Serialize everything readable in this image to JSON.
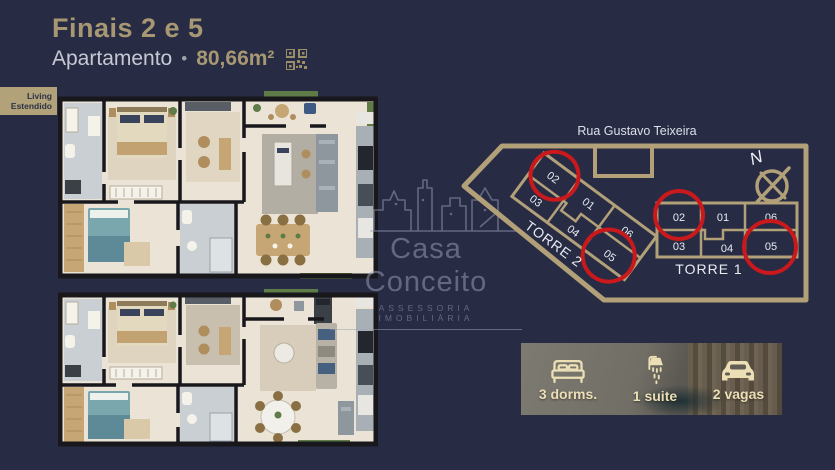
{
  "header": {
    "title": "Finais 2 e 5",
    "subtitle": "Apartamento",
    "separator": "•",
    "area": "80,66m²"
  },
  "badge": {
    "label": "Living Estendido"
  },
  "watermark": {
    "brand": "Casa Conceito",
    "tagline": "ASSESSORIA IMOBILIÁRIA"
  },
  "site_plan": {
    "street": "Rua Gustavo Teixeira",
    "north": "N",
    "tower_1": {
      "name": "TORRE 1",
      "units": {
        "u02": "02",
        "u01": "01",
        "u06": "06",
        "u03": "03",
        "u04": "04",
        "u05": "05"
      },
      "highlighted_units": "02, 05"
    },
    "tower_2": {
      "name": "TORRE 2",
      "units": {
        "u02": "02",
        "u01": "01",
        "u06": "06",
        "u03": "03",
        "u04": "04",
        "u05": "05"
      },
      "highlighted_units": "02, 05"
    }
  },
  "features": {
    "dorms": "3 dorms.",
    "suite": "1 suite",
    "vagas": "2 vagas"
  },
  "colors": {
    "background": "#272b44",
    "gold": "#a79873",
    "site_outline": "#b2a078",
    "highlight_red": "#c9191c",
    "cream_icons": "#ecdfb6"
  }
}
